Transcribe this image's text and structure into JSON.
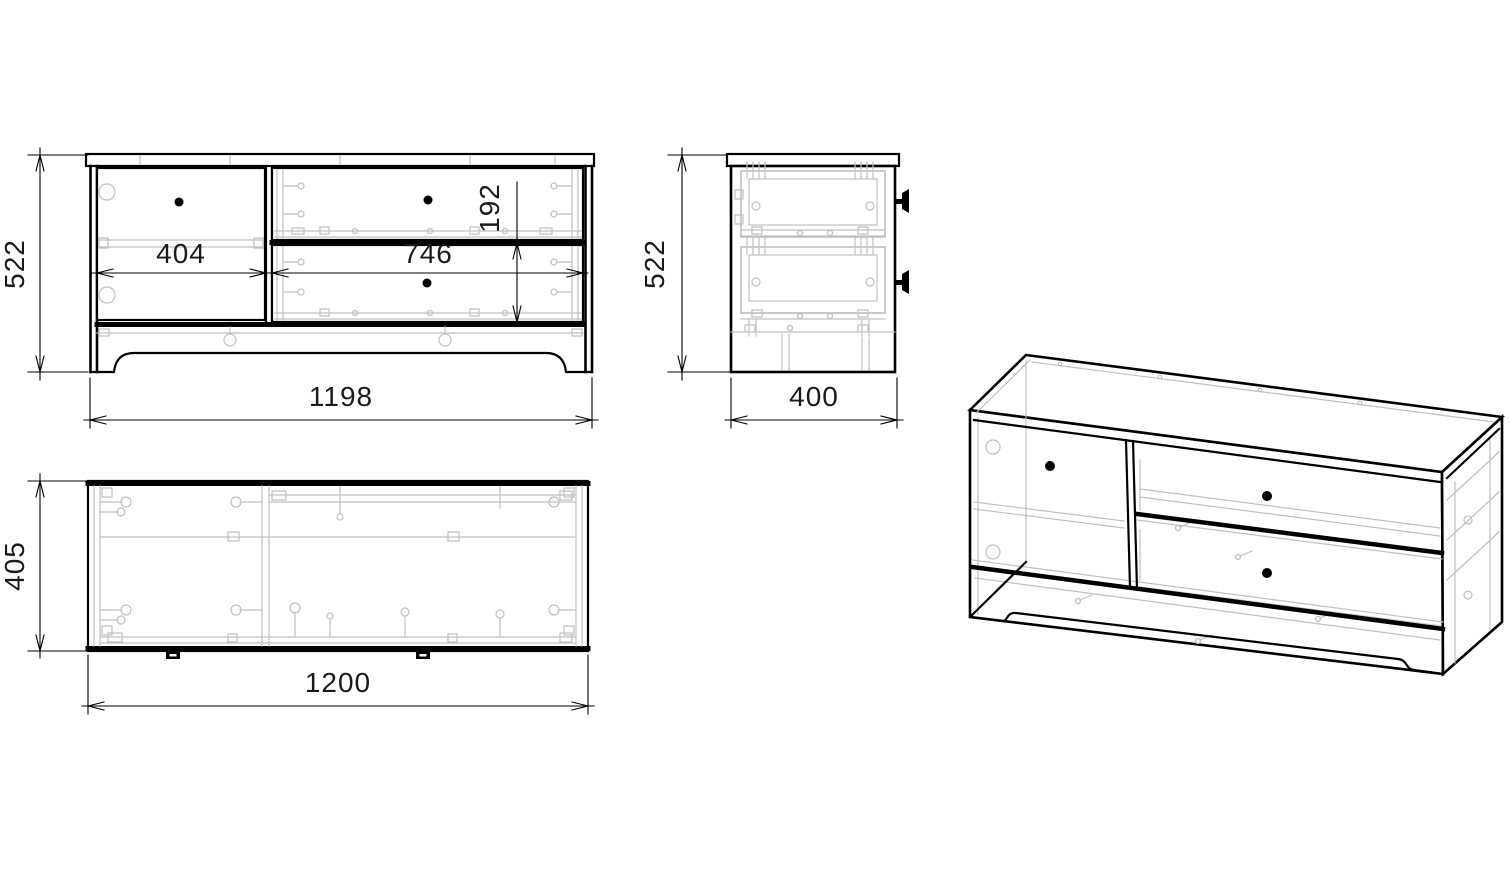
{
  "colors": {
    "outline": "#000000",
    "construction": "#c0c0c0",
    "dimension_text": "#1a1a1a",
    "background": "#ffffff"
  },
  "views": {
    "front": {
      "dim_height": "522",
      "dim_width": "1198",
      "dim_door_width": "404",
      "dim_drawer_width": "746",
      "dim_drawer_height": "192"
    },
    "side": {
      "dim_height": "522",
      "dim_depth": "400"
    },
    "top": {
      "dim_width": "1200",
      "dim_depth": "405"
    }
  }
}
